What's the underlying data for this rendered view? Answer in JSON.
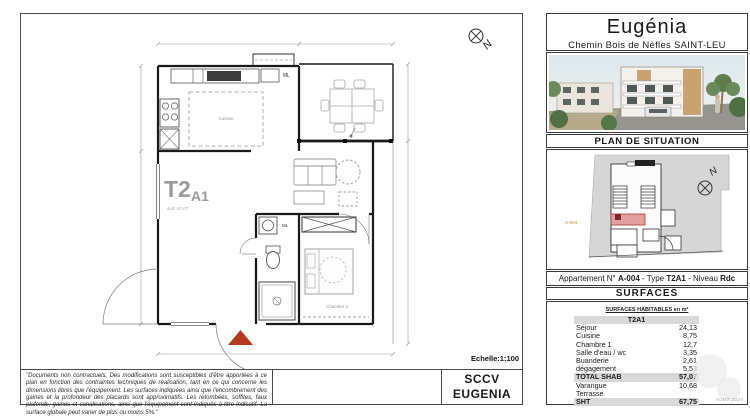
{
  "sheet": {
    "scale_label": "Echelle:1:100",
    "company_line1": "SCCV",
    "company_line2": "EUGENIA",
    "disclaimer": "\"Documents non contractuels. Des modifications sont susceptibles d'être apportées à ce plan en fonction des contraintes techniques de réalisation, tant en ce qui concerne les dimensions libres que l'équipement. Les surfaces indiquées ainsi que l'encombrement des gaines et la profondeur des placards sont approximatifs. Les retombées, soffites, faux plafonds, gaines et canalisations, ainsi que l'équipement sont indiqués à titre indicatif. La surface globale peut varier de plus ou moins 5%.\""
  },
  "plan": {
    "unit_main": "T2",
    "unit_sub": "A1",
    "area_caption": "surf. 57,07",
    "kitchen_label": "Cuisine",
    "bedroom_label": "Chambre 1",
    "ml_label": "ML",
    "north_letter": "N"
  },
  "sidebar": {
    "title": "Eugénia",
    "subtitle": "Chemin Bois de Nèfles SAINT-LEU",
    "situation_header": "PLAN DE SITUATION",
    "situation_unit_tag": "A-004",
    "situation_north": "N",
    "apartment": {
      "parts": [
        "Appartement N° ",
        "A-004",
        " - Type ",
        "T2A1",
        " - Niveau ",
        "Rdc"
      ]
    },
    "surfaces_header": "SURFACES",
    "table": {
      "mini_header": "SURFACES HABITABLES en m²",
      "type_header": "T2A1",
      "rows": [
        {
          "label": "Séjour",
          "value": "24,13"
        },
        {
          "label": "Cuisine",
          "value": "8,75"
        },
        {
          "label": "Chambre 1",
          "value": "12,7"
        },
        {
          "label": "Salle d'eau / wc",
          "value": "3,35"
        },
        {
          "label": "Buanderie",
          "value": "2,61"
        },
        {
          "label": "dégagement",
          "value": "5,53"
        },
        {
          "label": "TOTAL SHAB",
          "value": "57,07",
          "emphasis": true
        },
        {
          "label": "Varangue",
          "value": "10,68"
        },
        {
          "label": "Terrasse",
          "value": ""
        },
        {
          "label": "SHT",
          "value": "67,75",
          "emphasis": true
        }
      ],
      "stamp": "AOUT 2024"
    }
  },
  "colors": {
    "entrance_marker_red": "#b5391d",
    "table_row_gray": "#d9d9d9",
    "plan_label_gray": "#9b9b9b",
    "situation_highlight_pink": "#e29f9f",
    "situation_tag_orange": "#c8821e"
  }
}
